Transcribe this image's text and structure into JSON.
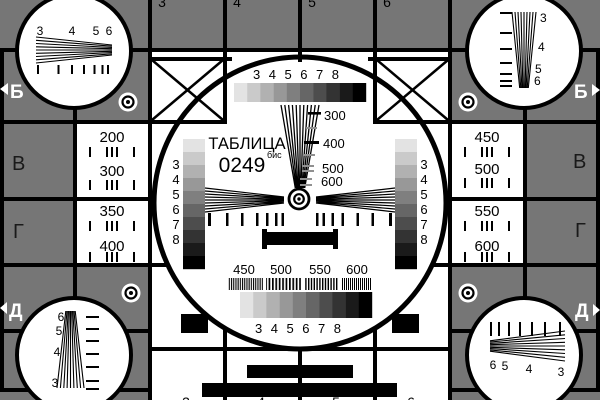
{
  "colors": {
    "background": "#767676",
    "ink": "#000000",
    "paper": "#ffffff",
    "dim_ink": "#1a1a1a",
    "gray_dash": "#909090"
  },
  "grayscale_palette": [
    "#e3e3e3",
    "#cacaca",
    "#b1b1b1",
    "#989898",
    "#7f7f7f",
    "#666666",
    "#4d4d4d",
    "#333333",
    "#1a1a1a",
    "#000000"
  ],
  "card": {
    "title": "ТАБЛИЦА",
    "number": "0249",
    "number_suffix": "бис"
  },
  "center": {
    "top_digits": "3 4 5 6 7 8",
    "bottom_digits": "3 4 5 6 7 8",
    "left_digits": [
      "3",
      "4",
      "5",
      "6",
      "7",
      "8"
    ],
    "right_digits": [
      "3",
      "4",
      "5",
      "6",
      "7",
      "8"
    ],
    "wedge_labels": [
      "300",
      "400",
      "500",
      "600"
    ],
    "bottom_freq_labels": [
      "450",
      "500",
      "550",
      "600"
    ]
  },
  "side_panels": {
    "left": [
      "200",
      "300",
      "350",
      "400"
    ],
    "right": [
      "450",
      "500",
      "550",
      "600"
    ]
  },
  "corners": {
    "top_left": [
      "3",
      "4",
      "5",
      "6"
    ],
    "top_right": [
      "3",
      "4",
      "5",
      "6"
    ],
    "bottom_left": [
      "6",
      "5",
      "4",
      "3"
    ],
    "bottom_right": [
      "6",
      "5",
      "4",
      "3"
    ]
  },
  "edge_letters": {
    "row2_left": "Б",
    "row2_right": "Б",
    "row3_left": "В",
    "row3_right": "В",
    "row4_left": "Г",
    "row4_right": "Г",
    "row5_left": "Д",
    "row5_right": "Д"
  },
  "edge_digits": {
    "top": [
      "3",
      "4",
      "5",
      "6"
    ],
    "bottom": [
      "3",
      "4",
      "5",
      "6"
    ]
  }
}
